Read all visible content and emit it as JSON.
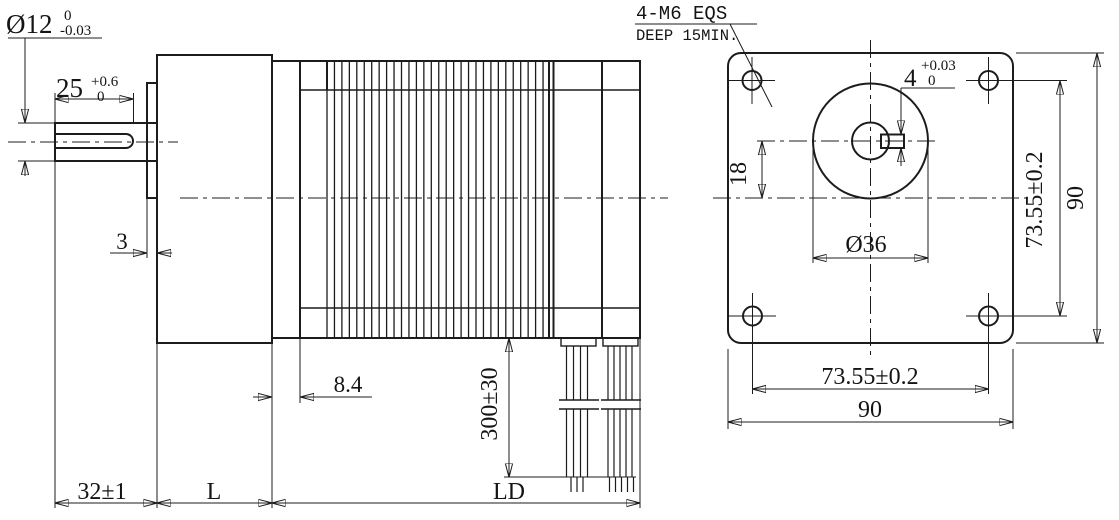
{
  "drawing": {
    "colors": {
      "line": "#1c1c1c",
      "background": "#ffffff"
    },
    "side_view": {
      "shaft_diameter": {
        "nominal": "Ø12",
        "upper": "0",
        "lower": "-0.03"
      },
      "keyway_length": {
        "nominal": "25",
        "upper": "+0.6",
        "lower": "0"
      },
      "pilot_depth": "3",
      "endbell_depth": "8.4",
      "lead_length": "300±30",
      "shaft_extension": "32±1",
      "gearbox_length": "L",
      "body_length": "LD"
    },
    "front_view": {
      "note_line1": "4-M6 EQS",
      "note_line2": "DEEP 15MIN.",
      "keyway_width": {
        "nominal": "4",
        "upper": "+0.03",
        "lower": "0"
      },
      "shaft_offset": "18",
      "pilot_diameter": "Ø36",
      "hole_pitch_vertical": "73.55±0.2",
      "flange_height": "90",
      "hole_pitch_horizontal": "73.55±0.2",
      "flange_width": "90"
    }
  }
}
